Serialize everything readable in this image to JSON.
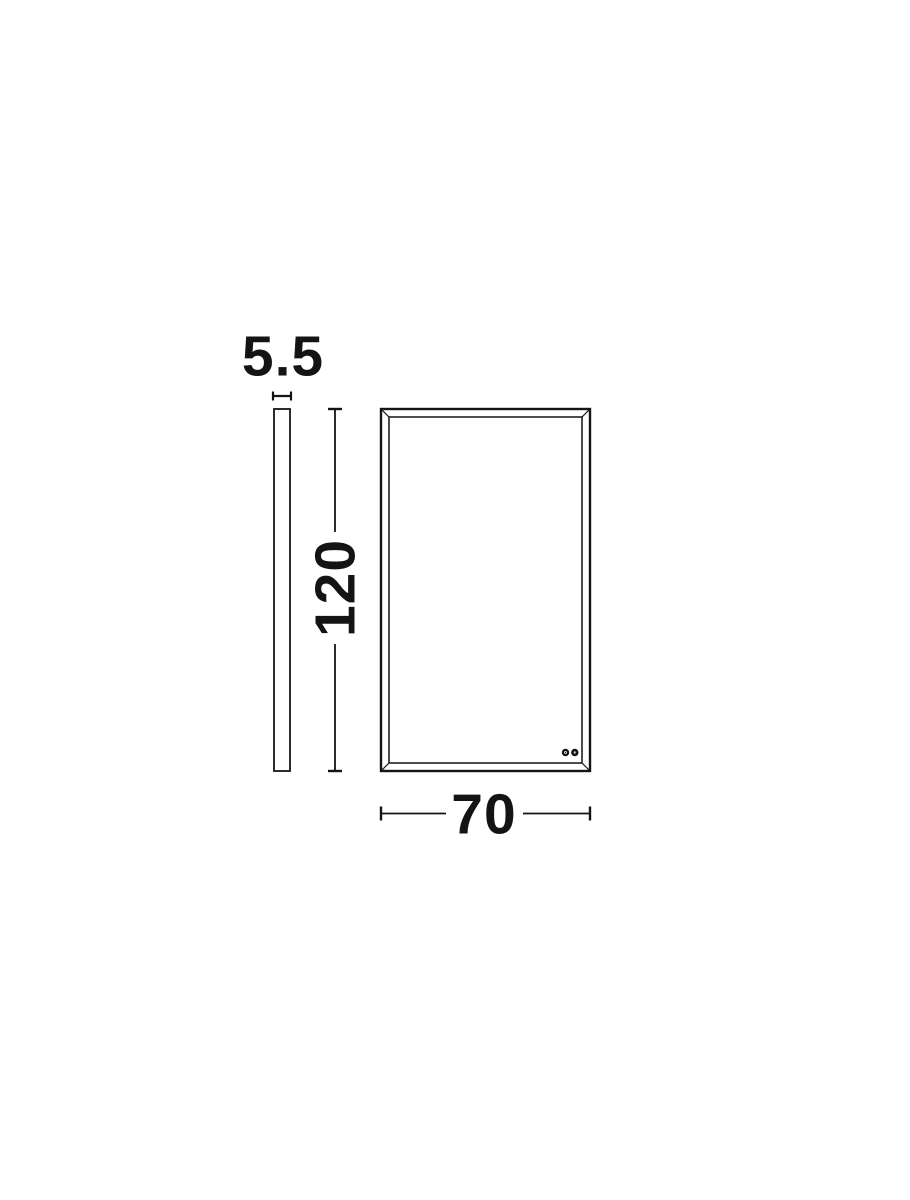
{
  "drawing": {
    "background_color": "#ffffff",
    "line_color": "#141414",
    "labels": {
      "thickness": "5.5",
      "height": "120",
      "width": "70"
    },
    "icons": {
      "touch_controls": [
        "touch-button-dot-icon",
        "touch-button-dot-icon"
      ]
    }
  }
}
